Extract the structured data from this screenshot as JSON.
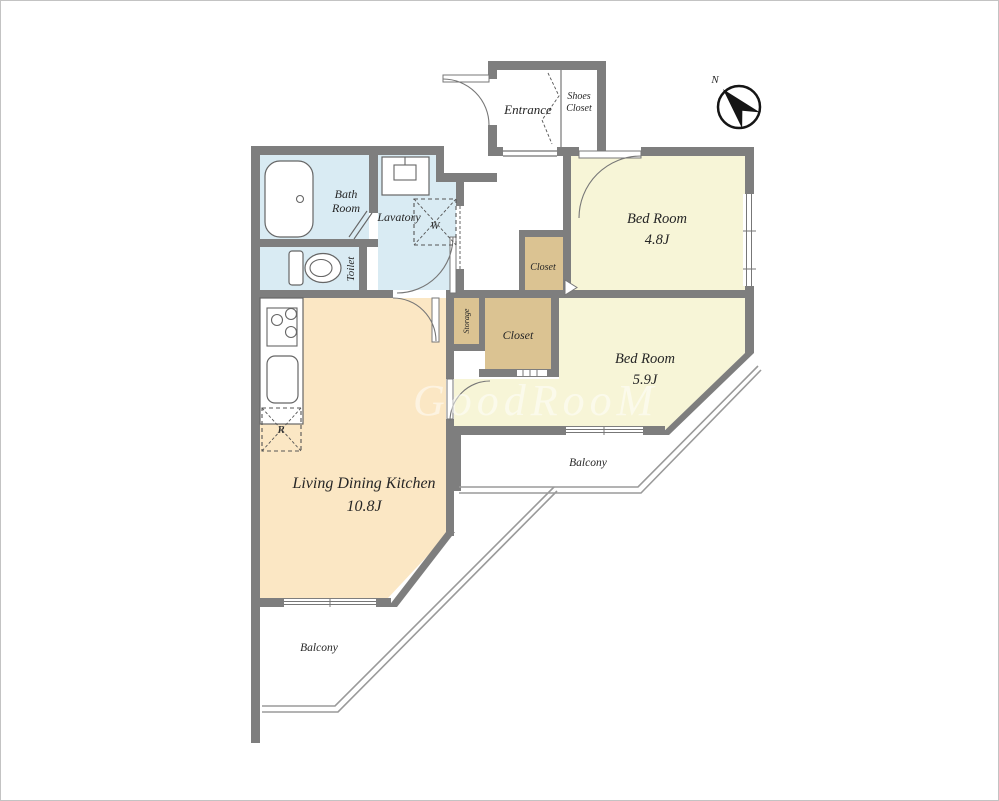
{
  "colors": {
    "wall": "#7e7e7e",
    "floor_wet": "#d9ebf3",
    "floor_bedroom": "#f7f5d7",
    "floor_ldk": "#fbe7c4",
    "floor_closet": "#dbc392",
    "floor_hall": "#ffffff"
  },
  "rooms": {
    "ldk": {
      "name": "Living Dining Kitchen",
      "area": "10.8J"
    },
    "bedroom1": {
      "name": "Bed Room",
      "area": "4.8J"
    },
    "bedroom2": {
      "name": "Bed Room",
      "area": "5.9J"
    },
    "bath": {
      "line1": "Bath",
      "line2": "Room"
    },
    "lavatory": {
      "name": "Lavatory"
    },
    "toilet": {
      "name": "Toilet"
    },
    "entrance": {
      "name": "Entrance"
    },
    "shoes_closet": {
      "line1": "Shoes",
      "line2": "Closet"
    },
    "closet_bedroom1": {
      "name": "Closet"
    },
    "closet_bedroom2": {
      "name": "Closet"
    },
    "storage": {
      "name": "Storage"
    },
    "balcony_upper": {
      "name": "Balcony"
    },
    "balcony_lower": {
      "name": "Balcony"
    }
  },
  "appliances": {
    "washer": "W",
    "fridge": "R"
  },
  "compass": {
    "north_label": "N"
  },
  "watermark": "GoodRooM"
}
